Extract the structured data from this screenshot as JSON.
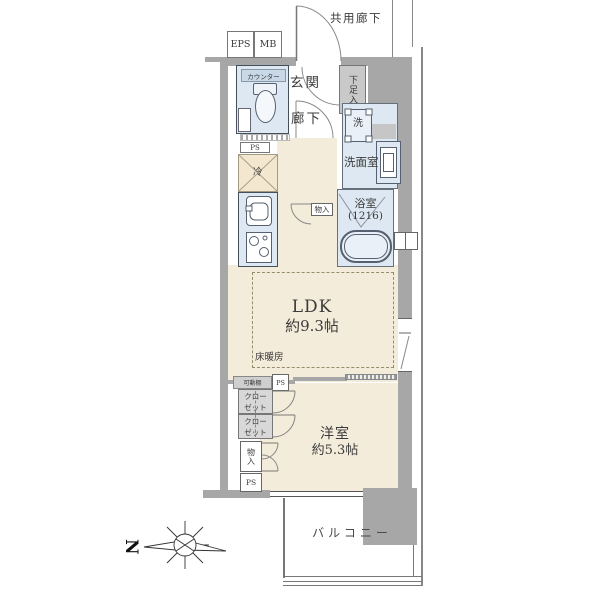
{
  "plan_title": "1LDK apartment floor plan",
  "colors": {
    "wall": "#a7a7a7",
    "floor": "#f4ecda",
    "wet_area": "#dde8f2",
    "closet_fill": "#d8d8d8",
    "shoe_cabinet_fill": "#c9c9c9",
    "counter_bar_fill": "#c9d8e6",
    "refrigerator_fill": "#f3e8cf",
    "text": "#3b3b3b"
  },
  "labels": {
    "common_corridor": "共用廊下",
    "eps": "EPS",
    "mb": "MB",
    "entrance": "玄関",
    "hallway": "廊下",
    "shoe_cabinet": "下足入",
    "toilet_counter": "カウンター",
    "ps": "PS",
    "refrigerator": "冷",
    "washer": "洗",
    "washroom": "洗面室",
    "bathroom": "浴室",
    "bathroom_size": "(1216)",
    "storage": "物入",
    "ldk": "LDK",
    "ldk_size": "約9.3帖",
    "floor_heating": "床暖房",
    "movable_shelf": "可動棚",
    "closet": "クロー\nゼット",
    "western_room": "洋室",
    "western_room_size": "約5.3帖",
    "storage_bottom": "物入",
    "balcony": "バルコニー",
    "north": "N"
  }
}
